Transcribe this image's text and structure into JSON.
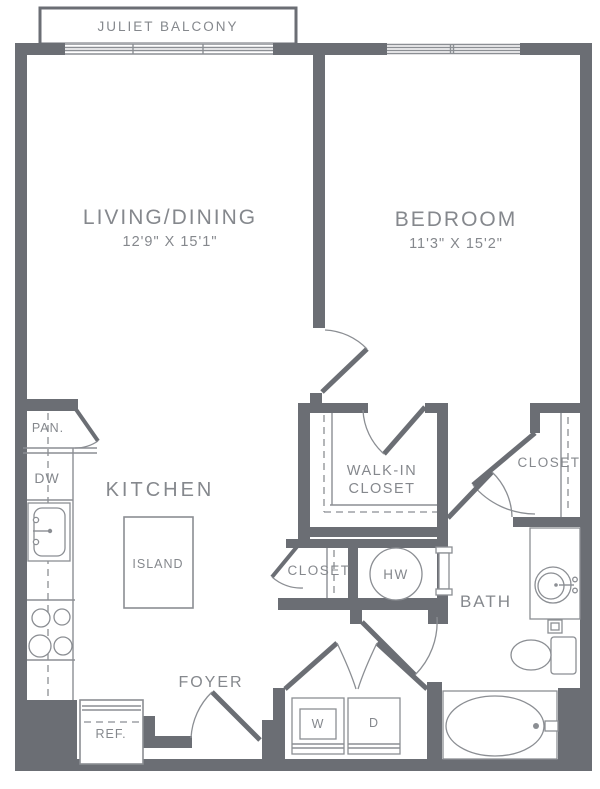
{
  "floor_plan": {
    "balcony": {
      "label": "JULIET BALCONY"
    },
    "living_dining": {
      "label": "LIVING/DINING",
      "dimensions": "12'9\" X 15'1\""
    },
    "bedroom": {
      "label": "BEDROOM",
      "dimensions": "11'3\" X 15'2\""
    },
    "kitchen": {
      "label": "KITCHEN"
    },
    "island": {
      "label": "ISLAND"
    },
    "pantry": {
      "label": "PAN."
    },
    "dishwasher": {
      "label": "DW"
    },
    "refrigerator": {
      "label": "REF."
    },
    "walk_in_closet": {
      "line1": "WALK-IN",
      "line2": "CLOSET"
    },
    "hall_closet": {
      "label": "CLOSET"
    },
    "bedroom_closet": {
      "label": "CLOSET"
    },
    "water_heater": {
      "label": "HW"
    },
    "bath": {
      "label": "BATH"
    },
    "foyer": {
      "label": "FOYER"
    },
    "washer": {
      "label": "W"
    },
    "dryer": {
      "label": "D"
    },
    "colors": {
      "wall": "#6b6e74",
      "fixture_line": "#8b8e93",
      "label_text": "#85888d"
    }
  }
}
